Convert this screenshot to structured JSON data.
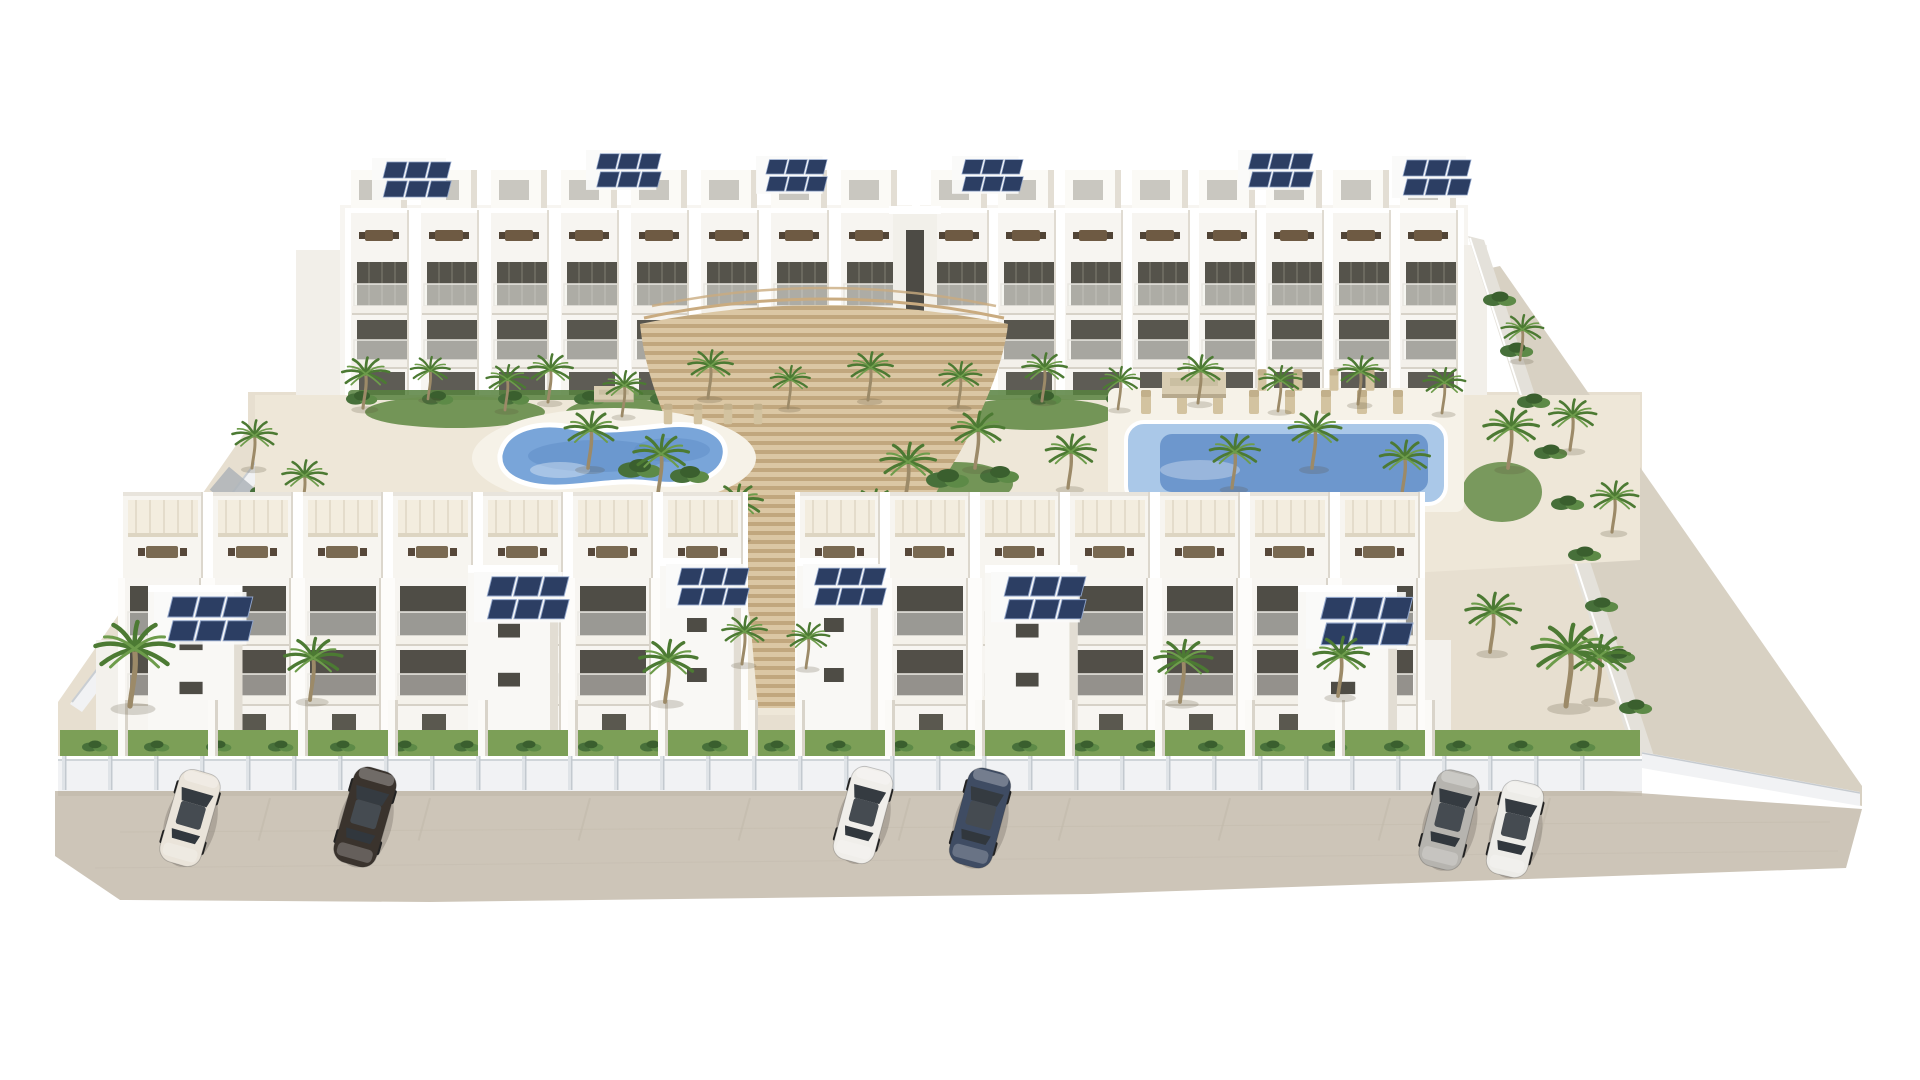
{
  "scene_type": "architectural-3d-render-residential-complex",
  "palette": {
    "bldg": "#f7f5f1",
    "bldg-shadow": "#dcd7cd",
    "opening": "#55534b",
    "sand": "#eee7d8",
    "ground": "#e7dfd0",
    "road": "#cdc5b8",
    "grass": "#7c9f57",
    "hedge": "#57813f",
    "solar": "#2c3e63",
    "pool-light": "#aac8e8",
    "pool-mid": "#79a5d9",
    "pool-deep": "#5e8bc5",
    "deck-wood": "#dbc7a4",
    "deck-stripe": "#c1a77e",
    "canopy": "#d9cdb2",
    "fence": "#f1f2f4",
    "wall": "#e4e1da"
  },
  "scene": {
    "rows": [
      {
        "layer": "rear-left-units",
        "type": "rear-unit",
        "x0": 345,
        "y0": 210,
        "step": 70,
        "count": 8
      },
      {
        "layer": "rear-right-units",
        "type": "rear-unit",
        "x0": 925,
        "y0": 210,
        "step": 67,
        "count": 8
      },
      {
        "layer": "front-left-units",
        "type": "front-unit",
        "x0": 118,
        "y0": 492,
        "step": 90,
        "count": 7
      },
      {
        "layer": "front-right-units",
        "type": "front-unit",
        "x0": 795,
        "y0": 492,
        "step": 90,
        "count": 7
      },
      {
        "layer": "hedge-row",
        "type": "bush",
        "x0": 362,
        "y0": 399,
        "step": 76,
        "count": 15,
        "s": 0.8
      },
      {
        "layer": "left-hedge",
        "type": "bush",
        "x0": 112,
        "y0": 688,
        "step": 22,
        "stepY": -28,
        "count": 8,
        "s": 0.8
      },
      {
        "layer": "right-wall-green",
        "type": "bush",
        "x0": 1500,
        "y0": 300,
        "step": 17,
        "stepY": 51,
        "count": 9,
        "s": 0.85
      },
      {
        "layer": "grass-hedge",
        "type": "bush",
        "x0": 95,
        "y0": 747,
        "step": 62,
        "count": 25,
        "s": 0.65
      },
      {
        "layer": "pool-loungers",
        "type": "lounger",
        "x0": 1146,
        "y0": 402,
        "step": 36,
        "count": 8,
        "s": 1
      },
      {
        "layer": "pool-loungers",
        "type": "lounger",
        "x0": 1262,
        "y0": 380,
        "step": 36,
        "count": 4,
        "s": 0.9
      },
      {
        "layer": "pool-loungers",
        "type": "lounger",
        "x0": 668,
        "y0": 414,
        "step": 30,
        "count": 4,
        "s": 0.85
      },
      {
        "layer": "plot-walls-left",
        "type": "plotwall",
        "x0": 118,
        "y0": 700,
        "step": 90,
        "count": 8
      },
      {
        "layer": "plot-walls-right",
        "type": "plotwall",
        "x0": 795,
        "y0": 700,
        "step": 90,
        "count": 8
      },
      {
        "layer": "fence-posts",
        "type": "post",
        "x0": 62,
        "y0": 756,
        "step": 46,
        "count": 34
      },
      {
        "layer": "road-lines",
        "type": "parkline",
        "x0": 270,
        "y0": 798,
        "step": 160,
        "count": 9,
        "r": 15
      }
    ],
    "sprites": [
      {
        "layer": "rear-decor",
        "type": "solar",
        "x": 372,
        "y": 158,
        "s": 1.0
      },
      {
        "layer": "rear-decor",
        "type": "solar",
        "x": 586,
        "y": 150,
        "s": 0.95
      },
      {
        "layer": "rear-decor",
        "type": "solar",
        "x": 756,
        "y": 156,
        "s": 0.9
      },
      {
        "layer": "rear-decor",
        "type": "solar",
        "x": 952,
        "y": 156,
        "s": 0.9
      },
      {
        "layer": "rear-decor",
        "type": "solar",
        "x": 1238,
        "y": 150,
        "s": 0.95
      },
      {
        "layer": "rear-decor",
        "type": "solar",
        "x": 1392,
        "y": 156,
        "s": 1.0
      },
      {
        "layer": "courtyard-palms",
        "type": "palm",
        "x": 363,
        "y": 408,
        "s": 0.9
      },
      {
        "layer": "courtyard-palms",
        "type": "palm",
        "x": 428,
        "y": 399,
        "s": 0.75
      },
      {
        "layer": "courtyard-palms",
        "type": "palm",
        "x": 505,
        "y": 410,
        "s": 0.8
      },
      {
        "layer": "courtyard-palms",
        "type": "palm",
        "x": 548,
        "y": 402,
        "s": 0.85
      },
      {
        "layer": "courtyard-palms",
        "type": "palm",
        "x": 622,
        "y": 416,
        "s": 0.8
      },
      {
        "layer": "courtyard-palms",
        "type": "palm",
        "x": 708,
        "y": 398,
        "s": 0.85
      },
      {
        "layer": "courtyard-palms",
        "type": "palm",
        "x": 788,
        "y": 408,
        "s": 0.75
      },
      {
        "layer": "courtyard-palms",
        "type": "palm",
        "x": 868,
        "y": 400,
        "s": 0.85
      },
      {
        "layer": "courtyard-palms",
        "type": "palm",
        "x": 958,
        "y": 407,
        "s": 0.8
      },
      {
        "layer": "courtyard-palms",
        "type": "palm",
        "x": 1042,
        "y": 401,
        "s": 0.85
      },
      {
        "layer": "courtyard-palms",
        "type": "palm",
        "x": 1118,
        "y": 409,
        "s": 0.75
      },
      {
        "layer": "courtyard-palms",
        "type": "palm",
        "x": 1198,
        "y": 403,
        "s": 0.85
      },
      {
        "layer": "courtyard-palms",
        "type": "palm",
        "x": 1278,
        "y": 411,
        "s": 0.8
      },
      {
        "layer": "courtyard-palms",
        "type": "palm",
        "x": 1358,
        "y": 404,
        "s": 0.85
      },
      {
        "layer": "courtyard-palms",
        "type": "palm",
        "x": 1442,
        "y": 413,
        "s": 0.8
      },
      {
        "layer": "courtyard-palms",
        "type": "palm",
        "x": 588,
        "y": 468,
        "s": 1.0
      },
      {
        "layer": "courtyard-palms",
        "type": "palm",
        "x": 658,
        "y": 494,
        "s": 1.05
      },
      {
        "layer": "courtyard-palms",
        "type": "palm",
        "x": 905,
        "y": 502,
        "s": 1.05
      },
      {
        "layer": "courtyard-palms",
        "type": "palm",
        "x": 975,
        "y": 468,
        "s": 1.0
      },
      {
        "layer": "courtyard-palms",
        "type": "palm",
        "x": 1068,
        "y": 488,
        "s": 0.95
      },
      {
        "layer": "courtyard-palms",
        "type": "palm",
        "x": 1232,
        "y": 488,
        "s": 0.95
      },
      {
        "layer": "courtyard-palms",
        "type": "palm",
        "x": 1312,
        "y": 468,
        "s": 1.0
      },
      {
        "layer": "courtyard-palms",
        "type": "palm",
        "x": 1402,
        "y": 494,
        "s": 0.95
      },
      {
        "layer": "courtyard-palms",
        "type": "palm",
        "x": 252,
        "y": 468,
        "s": 0.85
      },
      {
        "layer": "courtyard-palms",
        "type": "palm",
        "x": 302,
        "y": 508,
        "s": 0.85
      },
      {
        "layer": "courtyard-palms",
        "type": "palm",
        "x": 1508,
        "y": 468,
        "s": 1.05
      },
      {
        "layer": "courtyard-palms",
        "type": "palm",
        "x": 735,
        "y": 538,
        "s": 0.95
      },
      {
        "layer": "courtyard-palms",
        "type": "palm",
        "x": 872,
        "y": 540,
        "s": 0.9
      },
      {
        "layer": "courtyard-bushes",
        "type": "bush",
        "x": 640,
        "y": 470,
        "s": 1.1
      },
      {
        "layer": "courtyard-bushes",
        "type": "bush",
        "x": 690,
        "y": 476,
        "s": 1.0
      },
      {
        "layer": "courtyard-bushes",
        "type": "bush",
        "x": 948,
        "y": 480,
        "s": 1.1
      },
      {
        "layer": "courtyard-bushes",
        "type": "bush",
        "x": 1000,
        "y": 476,
        "s": 1.0
      },
      {
        "layer": "courtyard-bushes",
        "type": "bush",
        "x": 600,
        "y": 520,
        "s": 0.9
      },
      {
        "layer": "courtyard-bushes",
        "type": "bush",
        "x": 920,
        "y": 525,
        "s": 0.9
      },
      {
        "layer": "courtyard-bushes",
        "type": "bush",
        "x": 270,
        "y": 520,
        "s": 0.9
      },
      {
        "layer": "courtyard-bushes",
        "type": "bush",
        "x": 230,
        "y": 560,
        "s": 0.8
      },
      {
        "layer": "courtyard-canopies",
        "type": "canopy",
        "x": 594,
        "y": 386,
        "s": 0.62
      },
      {
        "layer": "courtyard-canopies",
        "type": "canopy",
        "x": 1162,
        "y": 372,
        "s": 1.0
      },
      {
        "layer": "front-towers",
        "type": "tower",
        "x": 148,
        "y": 585,
        "sx": 1.05,
        "sy": 0.88
      },
      {
        "layer": "front-towers",
        "type": "tower",
        "x": 468,
        "y": 565,
        "sx": 1.0,
        "sy": 0.98
      },
      {
        "layer": "front-towers",
        "type": "tower",
        "x": 660,
        "y": 558,
        "sx": 0.9,
        "sy": 1.0
      },
      {
        "layer": "front-towers",
        "type": "tower",
        "x": 797,
        "y": 558,
        "sx": 0.9,
        "sy": 1.0
      },
      {
        "layer": "front-towers",
        "type": "tower",
        "x": 985,
        "y": 565,
        "sx": 1.03,
        "sy": 0.98
      },
      {
        "layer": "front-towers",
        "type": "tower",
        "x": 1298,
        "y": 585,
        "sx": 1.1,
        "sy": 0.88
      },
      {
        "layer": "front-decor",
        "type": "solar",
        "x": 154,
        "y": 592,
        "s": 1.25
      },
      {
        "layer": "front-decor",
        "type": "solar",
        "x": 474,
        "y": 572,
        "s": 1.2
      },
      {
        "layer": "front-decor",
        "type": "solar",
        "x": 666,
        "y": 564,
        "s": 1.05
      },
      {
        "layer": "front-decor",
        "type": "solar",
        "x": 803,
        "y": 564,
        "s": 1.05
      },
      {
        "layer": "front-decor",
        "type": "solar",
        "x": 991,
        "y": 572,
        "s": 1.2
      },
      {
        "layer": "front-decor",
        "type": "solar",
        "x": 1306,
        "y": 592,
        "s": 1.35
      },
      {
        "layer": "right-wall-green",
        "type": "palm",
        "x": 1520,
        "y": 360,
        "s": 0.8
      },
      {
        "layer": "right-wall-green",
        "type": "palm",
        "x": 1570,
        "y": 450,
        "s": 0.9
      },
      {
        "layer": "right-wall-green",
        "type": "palm",
        "x": 1612,
        "y": 532,
        "s": 0.9
      },
      {
        "layer": "front-palms",
        "type": "palm",
        "x": 130,
        "y": 706,
        "s": 1.5
      },
      {
        "layer": "front-palms",
        "type": "palm",
        "x": 310,
        "y": 700,
        "s": 1.1
      },
      {
        "layer": "front-palms",
        "type": "palm",
        "x": 665,
        "y": 702,
        "s": 1.1
      },
      {
        "layer": "front-palms",
        "type": "palm",
        "x": 742,
        "y": 664,
        "s": 0.85
      },
      {
        "layer": "front-palms",
        "type": "palm",
        "x": 806,
        "y": 668,
        "s": 0.8
      },
      {
        "layer": "front-palms",
        "type": "palm",
        "x": 1180,
        "y": 702,
        "s": 1.1
      },
      {
        "layer": "front-palms",
        "type": "palm",
        "x": 1338,
        "y": 696,
        "s": 1.05
      },
      {
        "layer": "front-palms",
        "type": "palm",
        "x": 1490,
        "y": 652,
        "s": 1.05
      },
      {
        "layer": "front-palms",
        "type": "palm",
        "x": 1596,
        "y": 700,
        "s": 1.15
      },
      {
        "layer": "front-palms",
        "type": "palm",
        "x": 1566,
        "y": 706,
        "s": 1.45
      },
      {
        "layer": "cars",
        "type": "car",
        "x": 190,
        "y": 818,
        "r": 16,
        "s": 0.92,
        "color": "#eae4da"
      },
      {
        "layer": "cars",
        "type": "car",
        "x": 365,
        "y": 817,
        "r": 16,
        "s": 0.95,
        "color": "#3a332d"
      },
      {
        "layer": "cars",
        "type": "car",
        "x": 863,
        "y": 815,
        "r": 15,
        "s": 0.92,
        "color": "#f0eeea"
      },
      {
        "layer": "cars",
        "type": "car",
        "x": 980,
        "y": 818,
        "r": 15,
        "s": 0.95,
        "color": "#3f4c63"
      },
      {
        "layer": "cars",
        "type": "car",
        "x": 1449,
        "y": 820,
        "r": 14,
        "s": 0.95,
        "color": "#b6b4af"
      },
      {
        "layer": "cars",
        "type": "car",
        "x": 1515,
        "y": 829,
        "r": 13,
        "s": 0.92,
        "color": "#edece8"
      }
    ]
  }
}
